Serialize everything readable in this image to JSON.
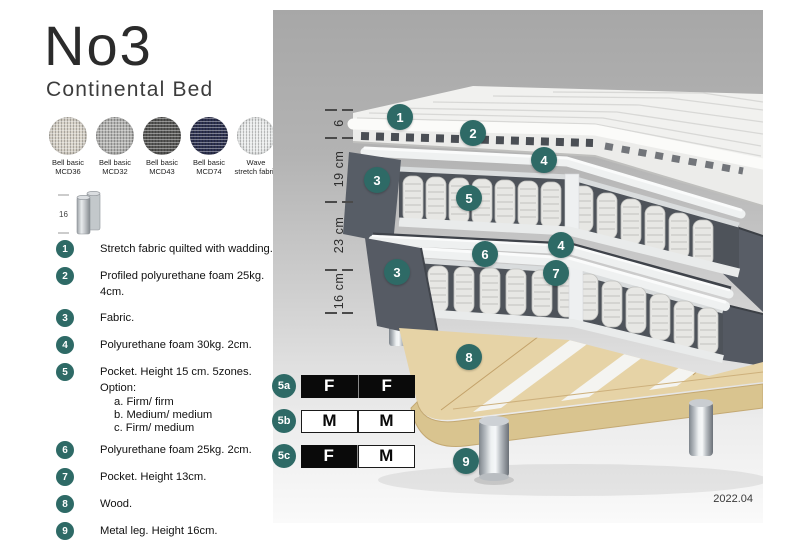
{
  "product": {
    "name": "No3",
    "subtitle": "Continental Bed"
  },
  "colors": {
    "accent": "#2e6a66",
    "table_dark": "#0a0a0a"
  },
  "swatches": [
    {
      "name": "Bell basic",
      "code": "MCD36",
      "color": "#d8d3c9"
    },
    {
      "name": "Bell basic",
      "code": "MCD32",
      "color": "#b3b3b1"
    },
    {
      "name": "Bell basic",
      "code": "MCD43",
      "color": "#585856"
    },
    {
      "name": "Bell basic",
      "code": "MCD74",
      "color": "#2e3251"
    },
    {
      "name": "Wave",
      "code": "stretch fabric",
      "color": "#e9ebeb"
    }
  ],
  "leg_icon": {
    "height_label": "16"
  },
  "legend": [
    {
      "num": "1",
      "text": "Stretch fabric quilted with wadding."
    },
    {
      "num": "2",
      "text": "Profiled polyurethane foam 25kg. 4cm."
    },
    {
      "num": "3",
      "text": "Fabric."
    },
    {
      "num": "4",
      "text": "Polyurethane foam 30kg. 2cm."
    },
    {
      "num": "5",
      "text": "Pocket. Height 15 cm. 5zones. Option:",
      "options": [
        "a. Firm/ firm",
        "b. Medium/ medium",
        "c. Firm/ medium"
      ]
    },
    {
      "num": "6",
      "text": "Polyurethane foam 25kg. 2cm."
    },
    {
      "num": "7",
      "text": "Pocket. Height 13cm."
    },
    {
      "num": "8",
      "text": "Wood."
    },
    {
      "num": "9",
      "text": "Metal leg. Height 16cm."
    }
  ],
  "diagram": {
    "measurements": [
      "6",
      "19 cm",
      "23 cm",
      "16 cm"
    ],
    "markers": [
      "1",
      "2",
      "3",
      "4",
      "5",
      "4",
      "3",
      "6",
      "7",
      "8",
      "9"
    ],
    "date": "2022.04"
  },
  "firmness_table": [
    {
      "label": "5a",
      "cells": [
        {
          "text": "F"
        },
        {
          "text": "F"
        }
      ]
    },
    {
      "label": "5b",
      "cells": [
        {
          "text": "M"
        },
        {
          "text": "M"
        }
      ]
    },
    {
      "label": "5c",
      "cells": [
        {
          "text": "F"
        },
        {
          "text": "M"
        }
      ]
    }
  ]
}
